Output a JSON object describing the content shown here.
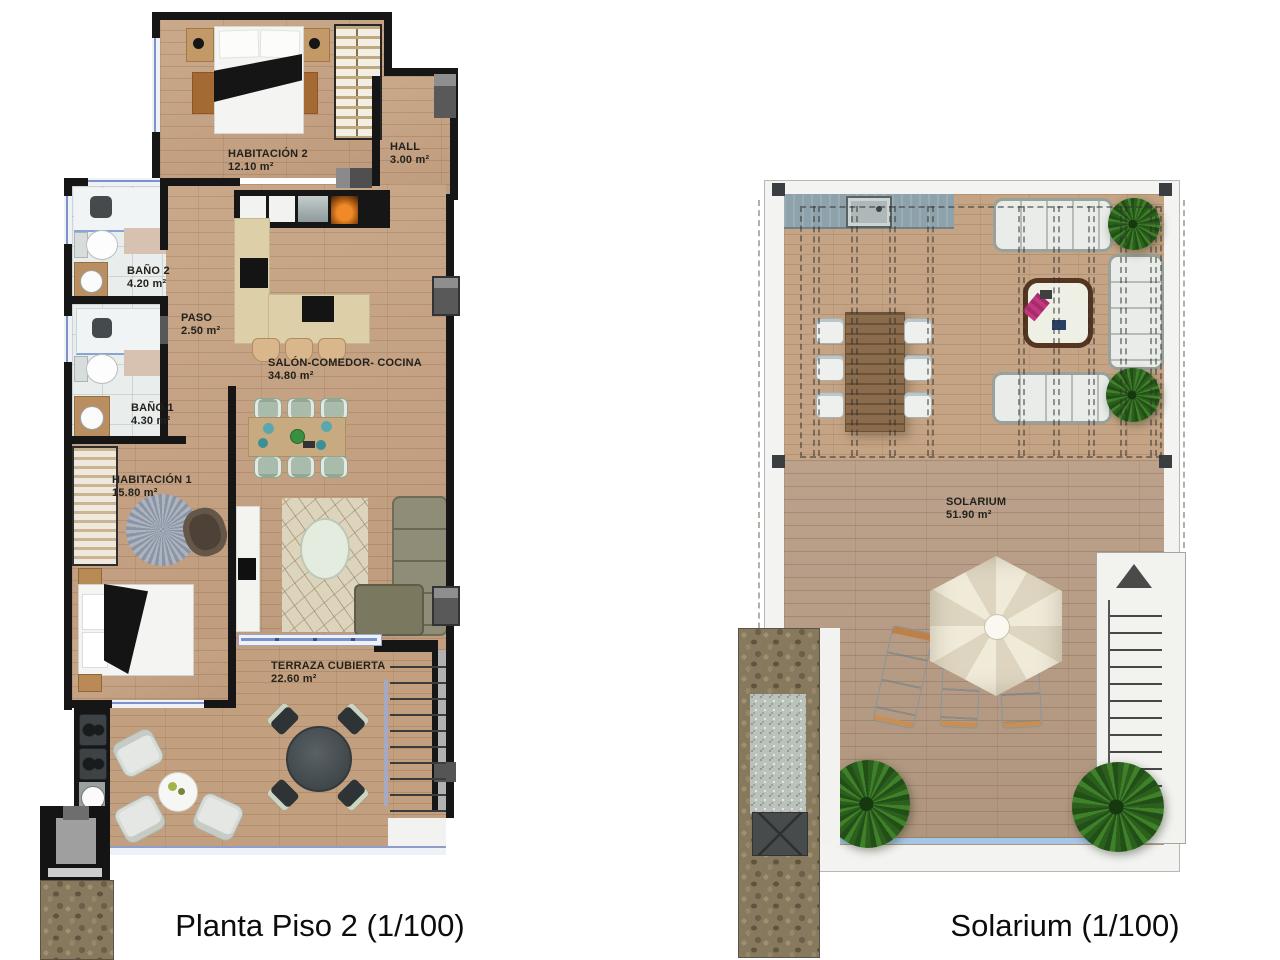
{
  "colors": {
    "wall": "#161616",
    "wood_interior": "#c6a282",
    "wood_terrace": "#c2a07f",
    "wood_solarium_upper": "#c4a484",
    "wood_solarium_lower": "#b89c85",
    "bath_floor": "#e9edec",
    "window_blue": "#7d93c8",
    "plant_green": "#2c5f1e",
    "label_text": "#23221c"
  },
  "plans": [
    {
      "id": "planta-piso-2",
      "title": "Planta Piso 2 (1/100)",
      "rooms": [
        {
          "name": "HABITACIÓN 2",
          "area": "12.10 m²"
        },
        {
          "name": "HALL",
          "area": "3.00 m²"
        },
        {
          "name": "BAÑO 2",
          "area": "4.20 m²"
        },
        {
          "name": "PASO",
          "area": "2.50 m²"
        },
        {
          "name": "SALÓN-COMEDOR- COCINA",
          "area": "34.80 m²"
        },
        {
          "name": "BAÑO 1",
          "area": "4.30 m²"
        },
        {
          "name": "HABITACIÓN 1",
          "area": "15.80 m²"
        },
        {
          "name": "TERRAZA CUBIERTA",
          "area": "22.60 m²"
        }
      ]
    },
    {
      "id": "solarium",
      "title": "Solarium (1/100)",
      "rooms": [
        {
          "name": "SOLARIUM",
          "area": "51.90 m²"
        }
      ]
    }
  ]
}
